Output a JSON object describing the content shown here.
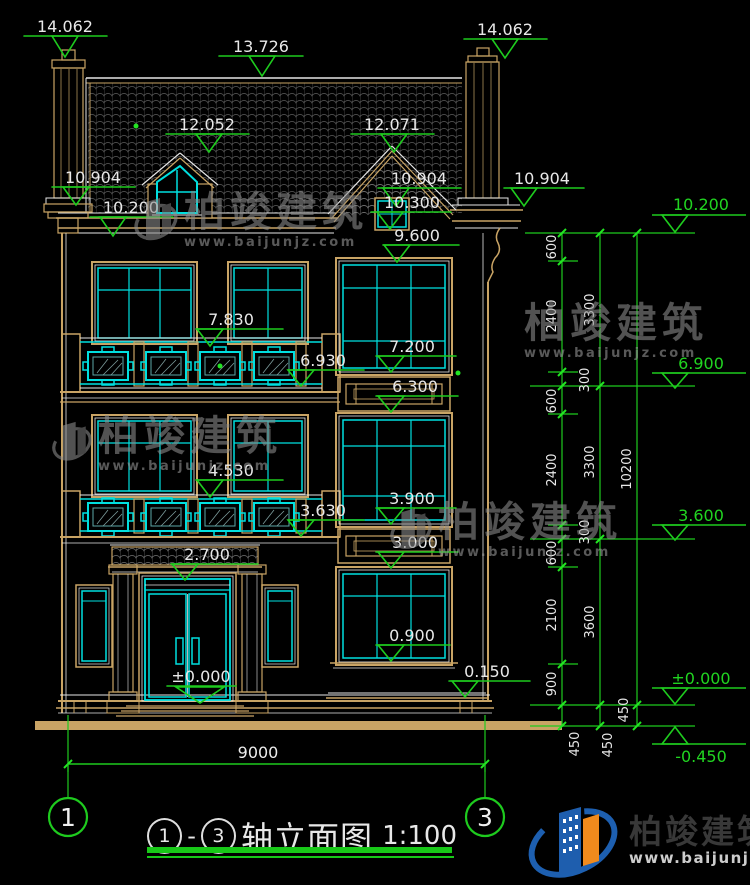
{
  "colors": {
    "dim_green": "#1ecb1e",
    "window_cyan": "#00dfdf",
    "wall_tan": "#c9a465",
    "line_white": "#e6e6e6",
    "logo_blue": "#1d5fb0",
    "logo_orange": "#f08a1d"
  },
  "markers": {
    "m14062l": "14.062",
    "m13726": "13.726",
    "m14062r": "14.062",
    "m12052": "12.052",
    "m12071": "12.071",
    "m10904l": "10.904",
    "m10904m": "10.904",
    "m10904r": "10.904",
    "m10200l": "10.200",
    "m10300": "10.300",
    "m9600": "9.600",
    "m7830": "7.830",
    "m7200": "7.200",
    "m6930": "6.930",
    "m6300": "6.300",
    "m4530": "4.530",
    "m3900": "3.900",
    "m3630": "3.630",
    "m3000": "3.000",
    "m2700": "2.700",
    "m0900": "0.900",
    "m0150": "0.150",
    "m0000": "±0.000"
  },
  "right_markers": {
    "r10200": "10.200",
    "r6900": "6.900",
    "r3600": "3.600",
    "r0000": "±0.000",
    "rneg0450": "-0.450"
  },
  "dim_chains": {
    "inner": [
      "600",
      "2400",
      "300",
      "600",
      "2400",
      "300",
      "600",
      "2100",
      "900",
      "450"
    ],
    "middle": [
      "3300",
      "3300",
      "3600",
      "450"
    ],
    "outer": [
      "10200",
      "450"
    ]
  },
  "bottom_dim": "9000",
  "axes": {
    "left": "1",
    "right": "3"
  },
  "title": {
    "axis_start": "1",
    "separator": "-",
    "axis_end": "3",
    "text": "轴立面图",
    "scale": "1:100"
  },
  "watermark": {
    "name": "柏竣建筑",
    "url": "www.baijunjz.com"
  },
  "brand": {
    "name": "柏竣建筑",
    "url": "www.baijunjz.com"
  }
}
